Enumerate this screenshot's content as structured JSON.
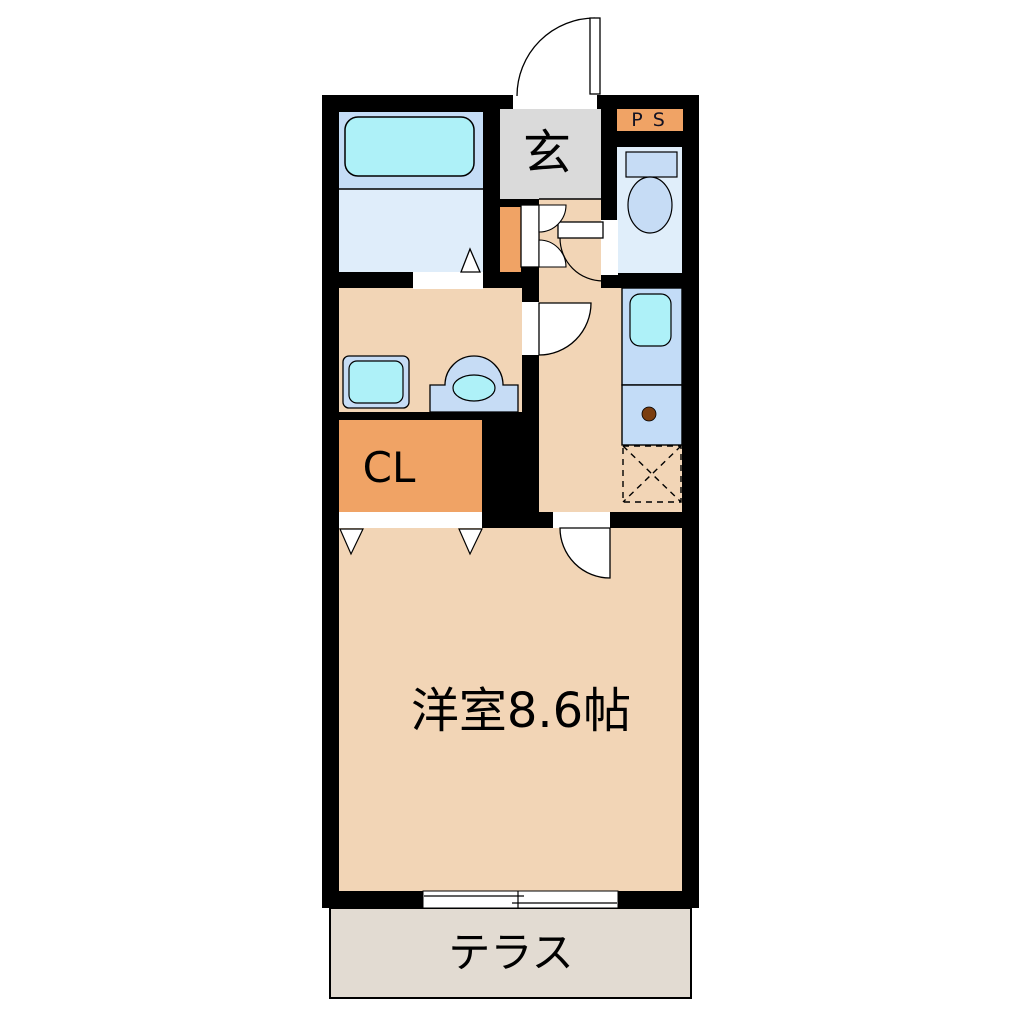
{
  "plan": {
    "labels": {
      "genkan": "玄",
      "ps": "P S",
      "closet": "CL",
      "main_room": "洋室8.6帖",
      "terrace": "テラス"
    },
    "colors": {
      "wall": "#000000",
      "white": "#FFFFFF",
      "peach": "#F2D5B6",
      "orange": "#F0A365",
      "genkan_gray": "#DADADA",
      "terrace": "#E2DBD2",
      "bathtub_area": "#C5DDF6",
      "bathroom_floor": "#DFEDFA",
      "toilet_floor": "#E0EEFA",
      "fixture_blue": "#C6DCF5",
      "fixture_cyan": "#AEF1F8",
      "counter": "#C3DCF7",
      "burner": "#7A3E10"
    }
  }
}
